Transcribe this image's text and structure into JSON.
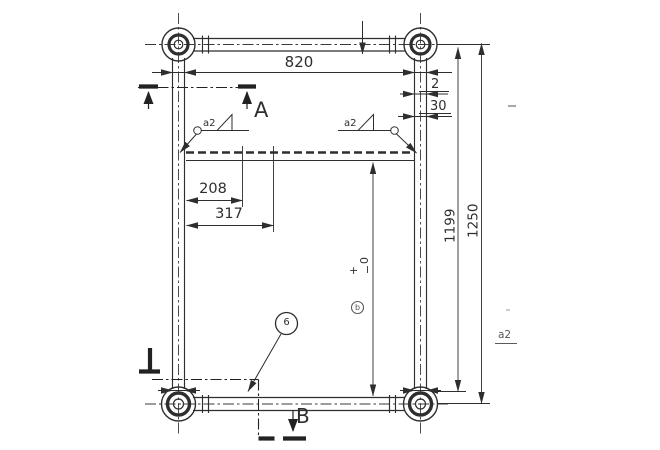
{
  "drawing": {
    "title": "weld-frame-top-view",
    "dims": {
      "top_width": "820",
      "gap": "2",
      "offset": "30",
      "hole_near": "208",
      "hole_far": "317",
      "inner_height": "1199",
      "total_height": "1250"
    },
    "tolerance": {
      "plus": "+",
      "minus": "−",
      "zero": "0"
    },
    "sections": {
      "a": "A",
      "b": "B"
    },
    "welds": {
      "left": "a2",
      "right": "a2",
      "margin_note": "a2"
    },
    "balloons": {
      "item": "6",
      "datum": "b"
    },
    "colors": {
      "ink": "#2e2e2e",
      "faint": "#5a5a5a",
      "background": "#ffffff"
    }
  }
}
